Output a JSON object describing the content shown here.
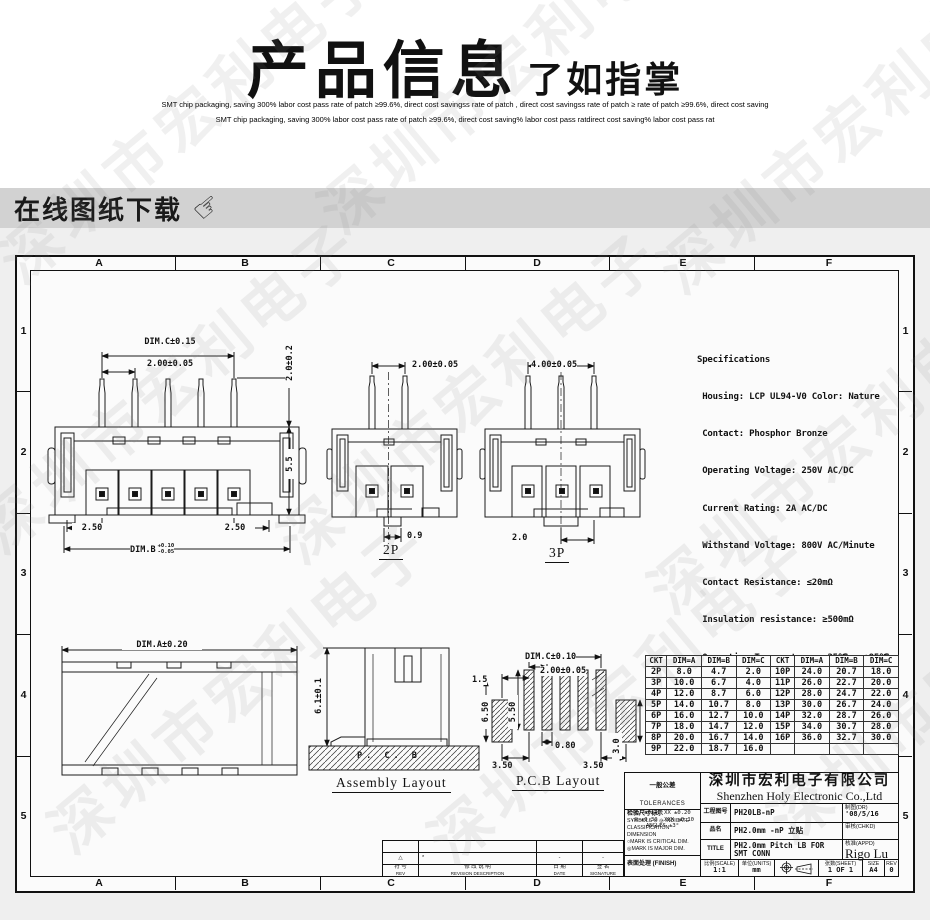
{
  "header": {
    "title_main": "产品信息",
    "title_sub": "了如指掌",
    "subtitle_line1": "SMT chip packaging, saving 300% labor cost   pass rate of patch ≥99.6%, direct cost savingss rate of patch , direct cost savingss rate of patch ≥ rate of patch ≥99.6%, direct cost saving",
    "subtitle_line2": "SMT chip packaging, saving 300% labor cost   pass rate of patch ≥99.6%, direct cost saving% labor cost   pass ratdirect cost saving% labor cost   pass rat"
  },
  "download_bar": {
    "label": "在线图纸下载",
    "icon": "pointing-hand-icon"
  },
  "sheet": {
    "zone_letters": [
      "A",
      "B",
      "C",
      "D",
      "E",
      "F"
    ],
    "zone_numbers": [
      "1",
      "2",
      "3",
      "4",
      "5"
    ],
    "watermark": "深圳市宏利电子"
  },
  "specifications": {
    "title": "Specifications",
    "lines": [
      " Housing: LCP UL94-V0 Color: Nature",
      " Contact: Phosphor Bronze",
      " Operating Voltage: 250V AC/DC",
      " Current Rating: 2A AC/DC",
      " Withstand Voltage: 800V AC/Minute",
      " Contact Resistance: ≤20mΩ",
      " Insulation resistance: ≥500mΩ",
      " Operating Temperature: -25℃ ~ +85℃"
    ]
  },
  "views": {
    "front": {
      "top_span": "DIM.C±0.15",
      "pitch": "2.00±0.05",
      "pin_height": "2.0±0.2",
      "body_height": "5.5",
      "left_offset": "2.50",
      "right_offset": "2.50",
      "bottom_span": "DIM.B",
      "bottom_tol_up": "+0.10",
      "bottom_tol_dn": "-0.05"
    },
    "p2": {
      "label": "2P",
      "pitch": "2.00±0.05",
      "slot": "0.9"
    },
    "p3": {
      "label": "3P",
      "span": "4.00±0.05",
      "pitch": "2.0"
    },
    "assembly_top": {
      "dim": "DIM.A±0.20"
    },
    "assembly_side": {
      "caption": "Assembly Layout",
      "height": "6.1±0.1",
      "pcb_label": "P. C. B"
    },
    "pcb": {
      "caption": "P.C.B Layout",
      "span": "DIM.C±0.10",
      "pitch": "2.00±0.05",
      "d_15": "1.5",
      "d_650": "6.50",
      "d_550": "5.50",
      "d_080": "0.80",
      "d_350l": "3.50",
      "d_350r": "3.50",
      "d_30": "3.0"
    }
  },
  "dim_table": {
    "headers": [
      "CKT",
      "DIM=A",
      "DIM=B",
      "DIM=C",
      "CKT",
      "DIM=A",
      "DIM=B",
      "DIM=C"
    ],
    "rows": [
      [
        "2P",
        "8.0",
        "4.7",
        "2.0",
        "10P",
        "24.0",
        "20.7",
        "18.0"
      ],
      [
        "3P",
        "10.0",
        "6.7",
        "4.0",
        "11P",
        "26.0",
        "22.7",
        "20.0"
      ],
      [
        "4P",
        "12.0",
        "8.7",
        "6.0",
        "12P",
        "28.0",
        "24.7",
        "22.0"
      ],
      [
        "5P",
        "14.0",
        "10.7",
        "8.0",
        "13P",
        "30.0",
        "26.7",
        "24.0"
      ],
      [
        "6P",
        "16.0",
        "12.7",
        "10.0",
        "14P",
        "32.0",
        "28.7",
        "26.0"
      ],
      [
        "7P",
        "18.0",
        "14.7",
        "12.0",
        "15P",
        "34.0",
        "30.7",
        "28.0"
      ],
      [
        "8P",
        "20.0",
        "16.7",
        "14.0",
        "16P",
        "36.0",
        "32.7",
        "30.0"
      ],
      [
        "9P",
        "22.0",
        "18.7",
        "16.0",
        "",
        "",
        "",
        ""
      ]
    ]
  },
  "title_block": {
    "tolerances": {
      "cn": "一般公差",
      "en": "TOLERANCES",
      "l1": "X. ±0.40   XX ±0.20",
      "l2": ".X ±0.30  .XXX ±0.10",
      "l3": "ANGLES      ±3°"
    },
    "inspection": {
      "cn": "检验尺寸标示",
      "l1": "SYMBOLS ⊙ ◎ INDICATE",
      "l2": "CLASSIFICATION DIMENSION",
      "l3": "○MARK IS CRITICAL DIM.",
      "l4": "◎MARK IS MAJOR DIM."
    },
    "finish_label": "表面处理 (FINISH)",
    "company_cn": "深圳市宏利电子有限公司",
    "company_en": "Shenzhen Holy Electronic Co.,Ltd",
    "drawing_no_label": "工程图号",
    "drawing_no": "PH20LB-nP",
    "part_label": "品名",
    "part_name": "PH2.0mm -nP 立贴",
    "title_label": "TITLE",
    "title_value": "PH2.0mm Pitch LB FOR SMT  CONN",
    "dr_label": "制图(DR)",
    "dr_value": "'08/5/16",
    "chkd_label": "审核(CHKD)",
    "appd_label": "核准(APPD)",
    "appd_value": "Rigo Lu",
    "scale_label": "比例(SCALE)",
    "scale_value": "1:1",
    "units_label": "单位(UNITS)",
    "units_value": "mm",
    "sheet_label": "张数(SHEET)",
    "sheet_value": "1 OF 1",
    "size_label": "SIZE",
    "size_value": "A4",
    "rev_label": "REV",
    "rev_value": "0"
  },
  "revision_strip": {
    "mark": "△",
    "note": "*",
    "date_note": "-",
    "sig_note": "-",
    "col1_cn": "符 号",
    "col1_en": "REV",
    "col2_cn": "修 改 说 明",
    "col2_en": "REVISION DESCRIPTION",
    "col3_cn": "日 期",
    "col3_en": "DATE",
    "col4_cn": "签 名",
    "col4_en": "SIGNATURE"
  }
}
